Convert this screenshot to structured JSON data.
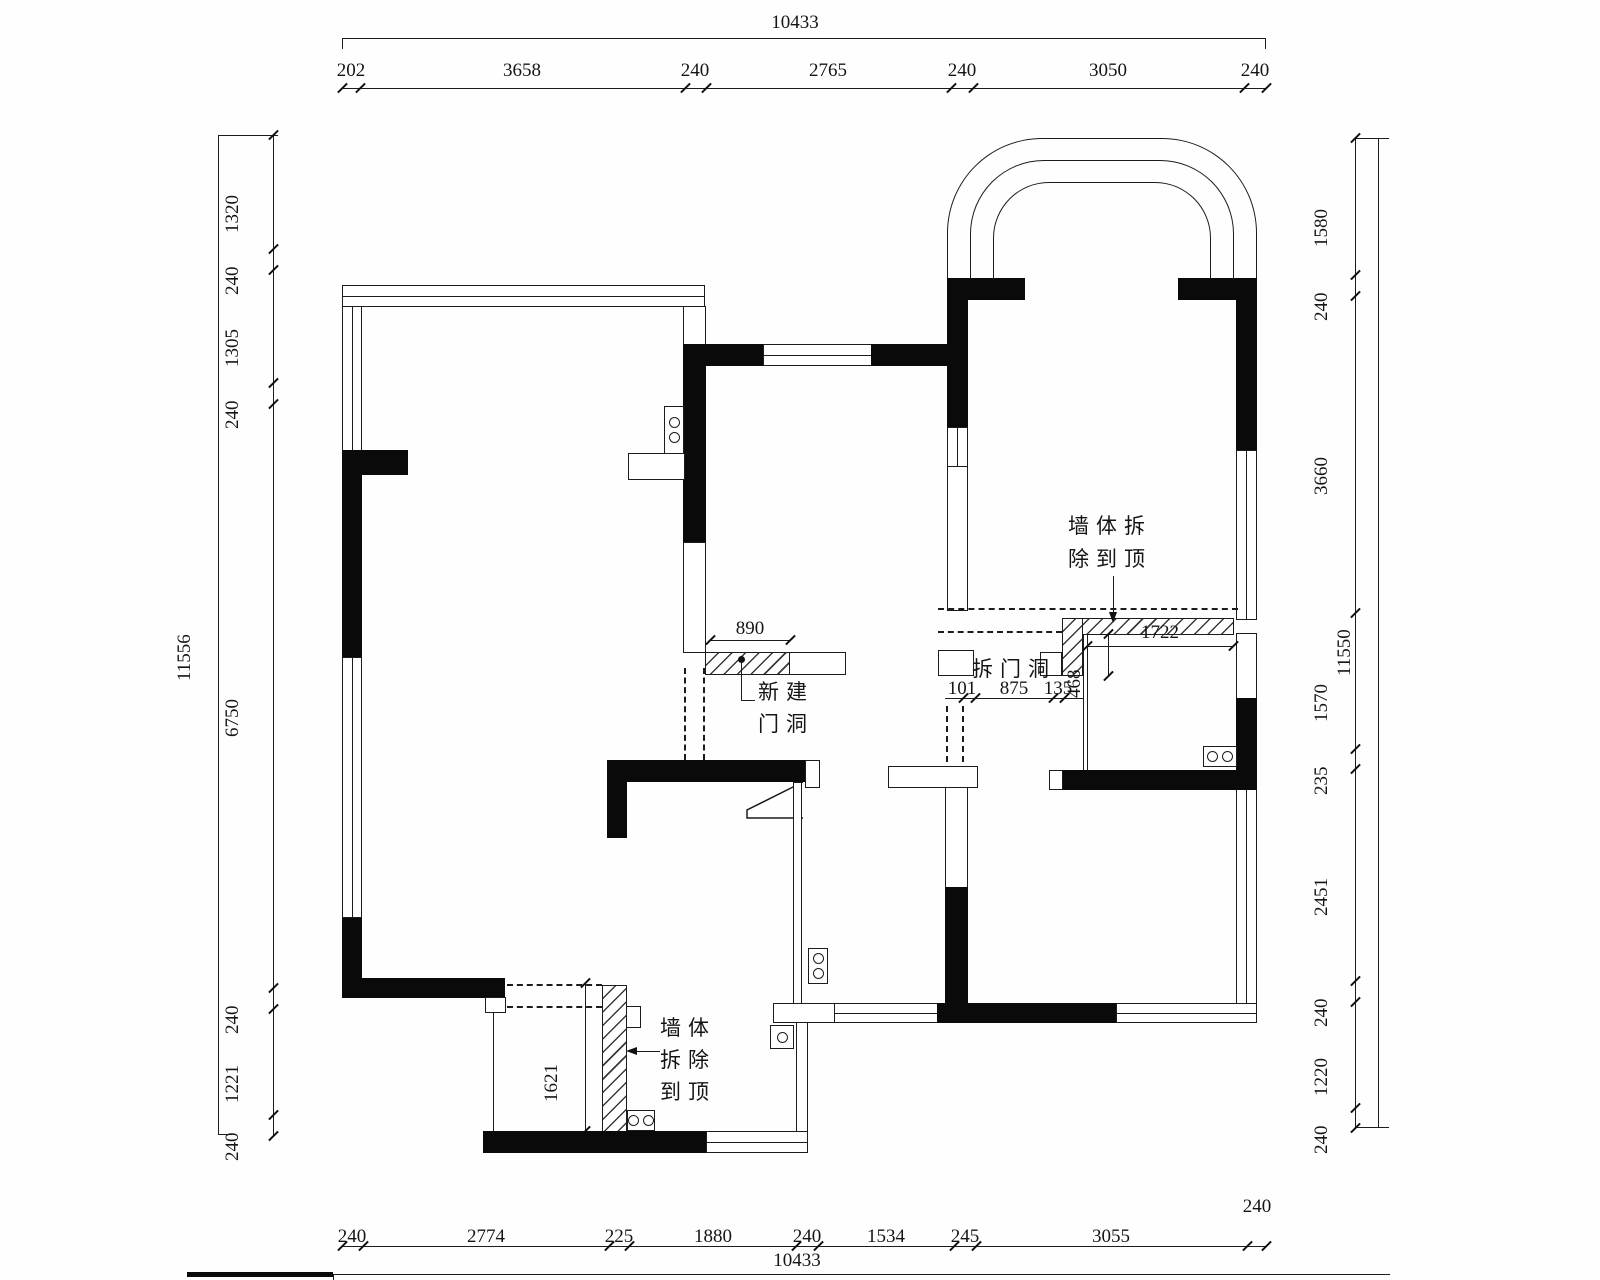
{
  "drawing": {
    "annotations": {
      "wall_demolish_top_l1": "墙体拆",
      "wall_demolish_top_l2": "除到顶",
      "demolish_door_label": "拆门洞",
      "new_door_l1": "新建",
      "new_door_l2": "门洞",
      "wall_demolish_bottom_l1": "墙体",
      "wall_demolish_bottom_l2": "拆除",
      "wall_demolish_bottom_l3": "到顶"
    },
    "dims": {
      "top": {
        "overall": "10433",
        "segments": [
          "202",
          "3658",
          "240",
          "2765",
          "240",
          "3050",
          "240"
        ]
      },
      "bottom": {
        "overall": "10433",
        "segments": [
          "240",
          "2774",
          "225",
          "1880",
          "240",
          "1534",
          "245",
          "3055",
          "240"
        ]
      },
      "left": {
        "overall": "11556",
        "segments": [
          "1320",
          "240",
          "1305",
          "240",
          "6750",
          "240",
          "1221",
          "240"
        ]
      },
      "right": {
        "overall": "11550",
        "segments": [
          "1580",
          "240",
          "3660",
          "1570",
          "235",
          "2451",
          "240",
          "1220",
          "240"
        ]
      },
      "interior": {
        "new_door_width": "890",
        "seg_101": "101",
        "seg_875": "875",
        "seg_135": "135",
        "len_1722": "1722",
        "off_468": "468",
        "h_1621": "1621"
      }
    },
    "colors": {
      "wall": "#0a0a0a",
      "line": "#1c1c1c",
      "bg": "#ffffff"
    }
  }
}
